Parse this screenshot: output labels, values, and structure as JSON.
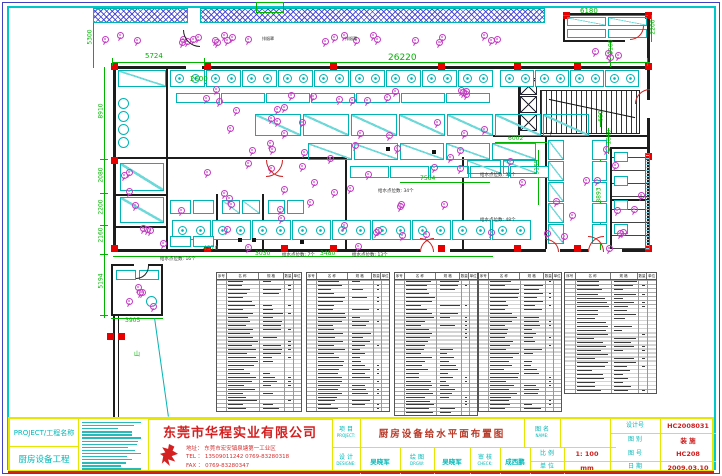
{
  "sheet": {
    "type": "CAD floor plan drawing",
    "border_colors": {
      "outer": "#4040c0",
      "inner": "#00c8c8"
    },
    "accent_colors": {
      "dimension": "#00b400",
      "equipment": "#00b4b4",
      "water_point": "#c23cc2",
      "column": "#e80000",
      "titleblock_grid": "#e6e600"
    }
  },
  "drawing": {
    "dimensions": [
      {
        "t": "5300",
        "x": 83,
        "y": 34,
        "v": 1
      },
      {
        "t": "5724",
        "x": 145,
        "y": 53,
        "s": 7
      },
      {
        "t": "26220",
        "x": 388,
        "y": 54,
        "s": 9
      },
      {
        "t": "6180",
        "x": 580,
        "y": 8,
        "s": 7
      },
      {
        "t": "2200",
        "x": 646,
        "y": 24,
        "v": 1
      },
      {
        "t": "3100",
        "x": 604,
        "y": 44,
        "v": 1
      },
      {
        "t": "2600",
        "x": 190,
        "y": 76,
        "s": 7
      },
      {
        "t": "8910",
        "x": 94,
        "y": 108,
        "v": 1
      },
      {
        "t": "2080",
        "x": 94,
        "y": 172,
        "v": 1
      },
      {
        "t": "2200",
        "x": 94,
        "y": 204,
        "v": 1
      },
      {
        "t": "2160",
        "x": 94,
        "y": 232,
        "v": 1
      },
      {
        "t": "5194",
        "x": 94,
        "y": 278,
        "v": 1
      },
      {
        "t": "3905",
        "x": 125,
        "y": 318
      },
      {
        "t": "4370",
        "x": 203,
        "y": 246
      },
      {
        "t": "3030",
        "x": 255,
        "y": 251
      },
      {
        "t": "3480",
        "x": 320,
        "y": 251
      },
      {
        "t": "7564",
        "x": 420,
        "y": 176
      },
      {
        "t": "6002",
        "x": 508,
        "y": 136
      },
      {
        "t": "1800",
        "x": 602,
        "y": 134,
        "v": 1
      },
      {
        "t": "8893",
        "x": 592,
        "y": 192,
        "v": 1
      },
      {
        "t": "5155",
        "x": 530,
        "y": 164,
        "v": 1
      },
      {
        "t": "600",
        "x": 596,
        "y": 113,
        "v": 1
      }
    ],
    "annotations": [
      {
        "t": "给水点位数: 16个",
        "x": 160,
        "y": 258
      },
      {
        "t": "给水点位数: 7个",
        "x": 282,
        "y": 254
      },
      {
        "t": "给水点位数: 13个",
        "x": 352,
        "y": 254
      },
      {
        "t": "给水点位数: 34个",
        "x": 378,
        "y": 190
      },
      {
        "t": "给水点位数: 31个",
        "x": 480,
        "y": 174
      },
      {
        "t": "给水点位数: 48个",
        "x": 480,
        "y": 219
      },
      {
        "t": "上",
        "x": 548,
        "y": 133,
        "c": "#222",
        "s": 6
      },
      {
        "t": "排烟罩",
        "x": 262,
        "y": 37,
        "s": 4
      },
      {
        "t": "排烟罩",
        "x": 345,
        "y": 37,
        "s": 4
      },
      {
        "t": "山",
        "x": 134,
        "y": 352,
        "c": "#00b400",
        "s": 6
      }
    ]
  },
  "equipment_tables": {
    "headers": [
      "序号",
      "名 称",
      "规 格",
      "数量",
      "单位"
    ],
    "tables": [
      {
        "rows": 33
      },
      {
        "rows": 33
      },
      {
        "rows": 34
      },
      {
        "rows": 33
      },
      {
        "rows": 28
      }
    ]
  },
  "title_block": {
    "project_label": "PROJECT/工程名称",
    "project_name": "厨房设备工程",
    "notes_line_count": 16,
    "company": {
      "name": "东莞市华程实业有限公司",
      "address": "地址： 东莞市宏安镇泉塘第一工业区",
      "tel": "TEL ： 13509011242   0769-83280318",
      "fax": "FAX ： 0769-83280347"
    },
    "fields": {
      "item_label": "项 目",
      "item_label_en": "PROJECT:",
      "item_value": "厨房设备给水平面布置图",
      "name_label": "图 名",
      "name_label_en": "NAME:",
      "name_value": "",
      "design_no_label": "设计号",
      "design_no": "HC2008031",
      "category_label": "图 别",
      "category": "装 施",
      "designer_label": "设 计",
      "designer_label_en": "DESIGNE:",
      "designer": "吴晓军",
      "draw_label": "绘 图",
      "draw_label_en": "DRGW:",
      "drawer": "吴晓军",
      "check_label": "审 核",
      "check_label_en": "CHECK:",
      "checker": "成西鹏",
      "scale_label": "比 例",
      "scale": "1: 100",
      "unit_label": "单 位",
      "unit": "mm",
      "sheet_no_label": "图 号",
      "sheet_no": "HC208",
      "date_label": "日 期",
      "date": "2009.03.10"
    }
  }
}
